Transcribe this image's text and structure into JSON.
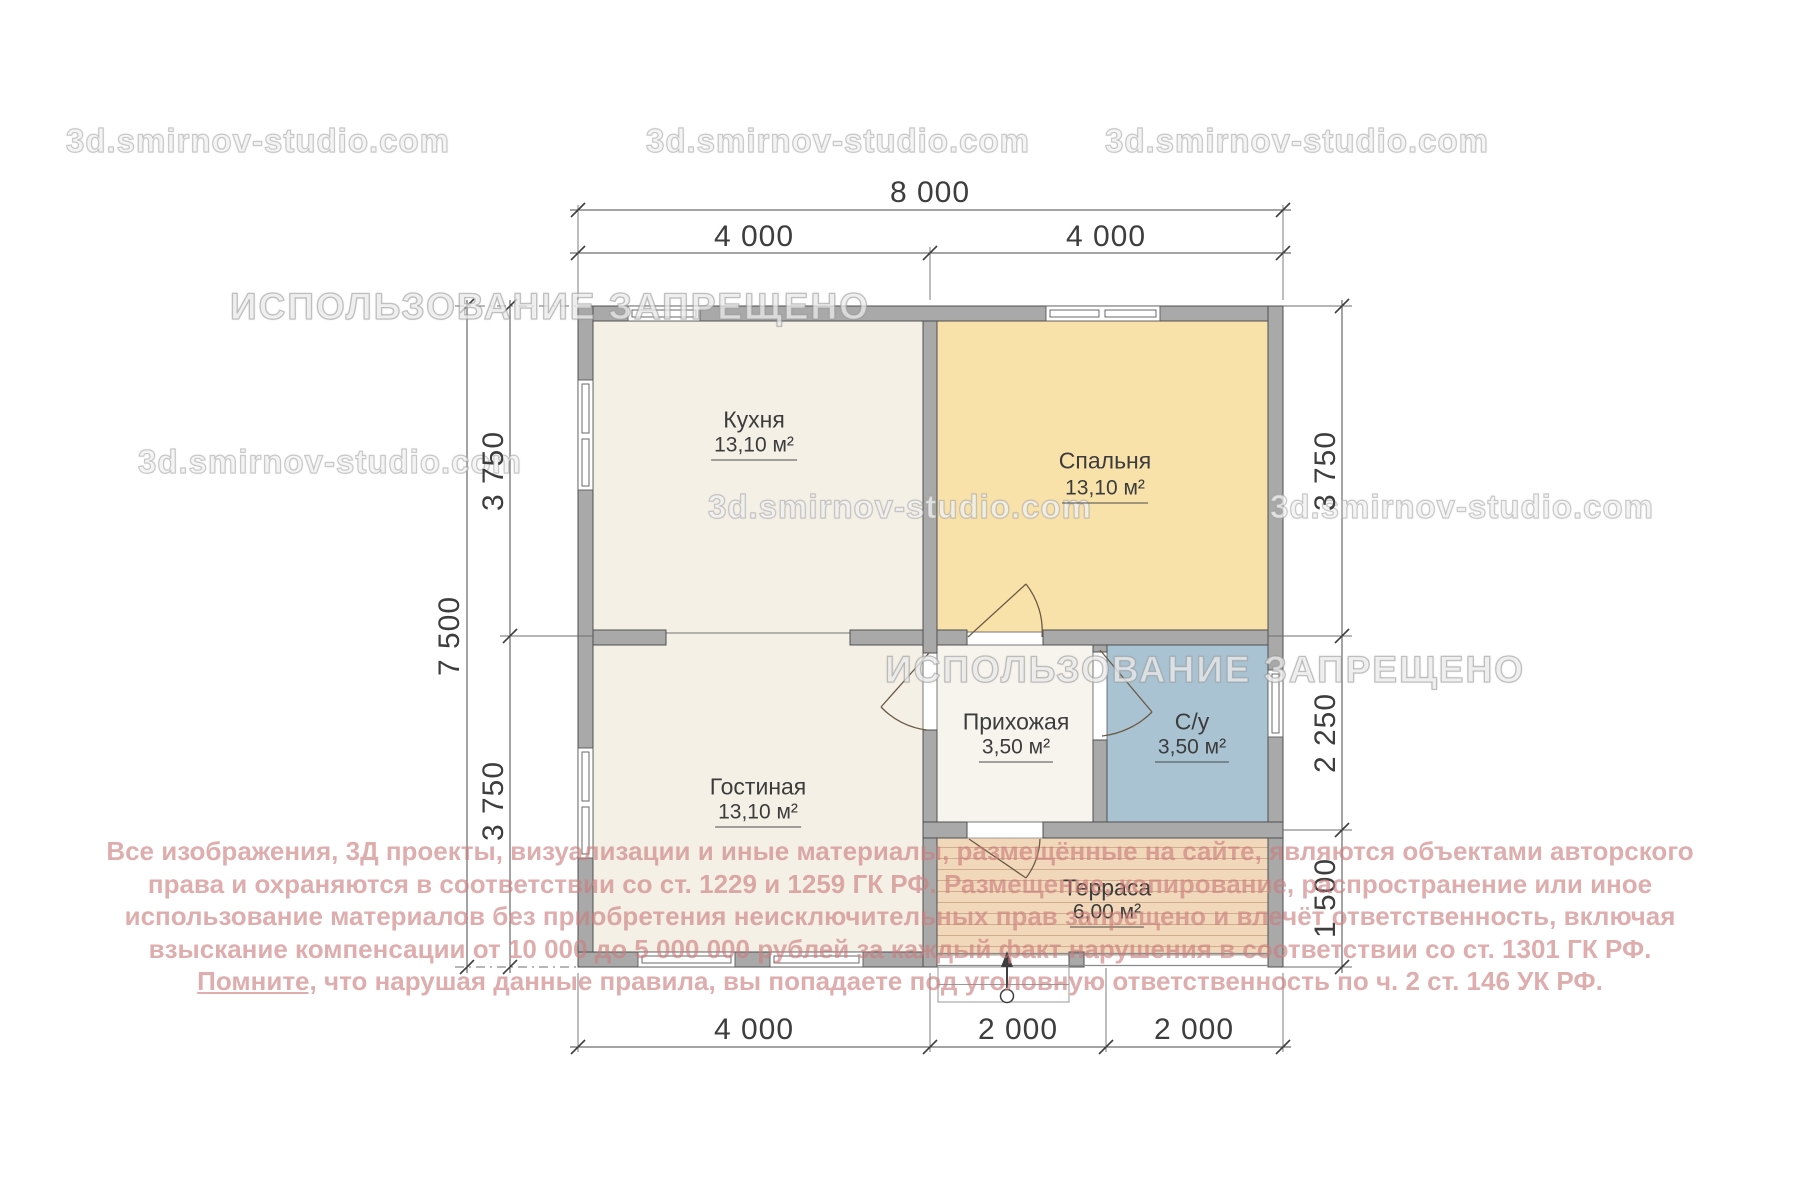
{
  "watermarks": {
    "site": "3d.smirnov-studio.com",
    "forbidden": "ИСПОЛЬЗОВАНИЕ ЗАПРЕЩЕНО"
  },
  "plan": {
    "rooms": [
      {
        "name": "Кухня",
        "area": "13,10 м²"
      },
      {
        "name": "Спальня",
        "area": "13,10 м²"
      },
      {
        "name": "Гостиная",
        "area": "13,10 м²"
      },
      {
        "name": "Прихожая",
        "area": "3,50 м²"
      },
      {
        "name": "С/у",
        "area": "3,50 м²"
      },
      {
        "name": "Терраса",
        "area": "6,00 м²"
      }
    ],
    "dimensions": {
      "top_total": "8 000",
      "top_left": "4 000",
      "top_right": "4 000",
      "left_total": "7 500",
      "left_upper": "3 750",
      "left_lower": "3 750",
      "right_upper": "3 750",
      "right_middle": "2 250",
      "right_lower": "1 500",
      "bottom_left": "4 000",
      "bottom_middle": "2 000",
      "bottom_right": "2 000"
    },
    "colors": {
      "wall": "#a9a9a9",
      "room_cream": "#f4f0e6",
      "room_hall": "#f7f4ee",
      "bedroom": "#f9e2aa",
      "bathroom": "#a9c3d3",
      "terrace": "#f2d8ba",
      "terrace_stripe": "#cfae8e",
      "dim_text": "#3d3d3d",
      "copyright_red": "#cb7c7c"
    }
  },
  "copyright": {
    "line1": "Все изображения, 3Д проекты, визуализации и иные материалы, размещённые на сайте, являются объектами авторского",
    "line2": "права и охраняются в соответствии со ст. 1229 и 1259 ГК РФ. Размещение, копирование, распространение или иное",
    "line3": "использование материалов без приобретения неисключительных прав запрещено и влечёт ответственность, включая",
    "line4": "взыскание компенсации от 10 000 до 5 000 000 рублей за каждый факт нарушения в соответствии со ст. 1301 ГК РФ.",
    "line5_underlined": "Помните,",
    "line5_rest": " что нарушая данные правила, вы попадаете под уголовную ответственность по ч. 2 ст. 146 УК РФ."
  }
}
